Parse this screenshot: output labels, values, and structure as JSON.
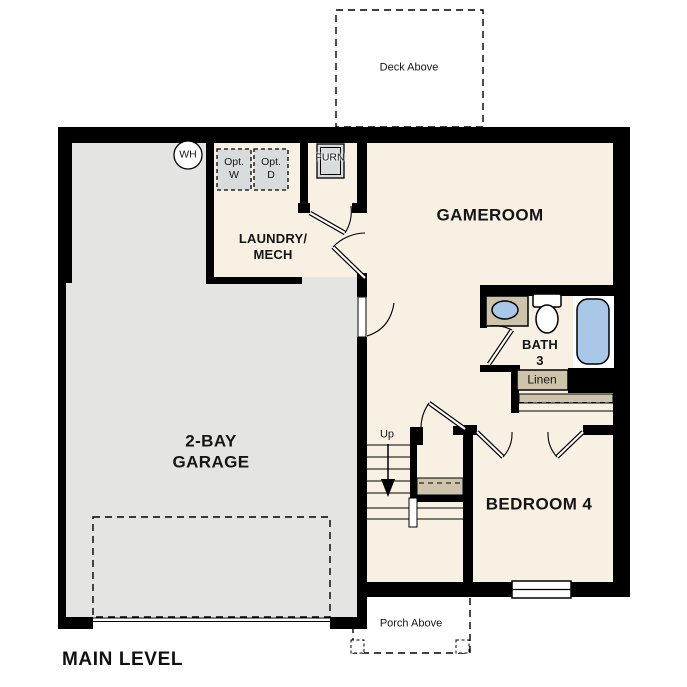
{
  "plan_title": {
    "label": "MAIN LEVEL"
  },
  "annotations": {
    "deck_above": "Deck Above",
    "porch_above": "Porch Above",
    "stairs_up": "Up"
  },
  "rooms": {
    "gameroom": "GAMEROOM",
    "laundry_mech": "LAUNDRY/\nMECH",
    "garage": "2-BAY\nGARAGE",
    "bath_3": "BATH\n3",
    "bedroom_4": "BEDROOM 4"
  },
  "closets": {
    "linen": "Linen"
  },
  "equipment": {
    "water_heater": "WH",
    "furnace": "FURN",
    "opt_washer": "Opt.\nW",
    "opt_dryer": "Opt.\nD"
  },
  "colors": {
    "wall": "#000000",
    "room_fill": "#f7f0e3",
    "garage_fill": "#e4e4e2",
    "fixture_tan": "#cec3ab",
    "fixture_blue": "#a9c7e6",
    "equipment_gray": "#d8dcdc"
  }
}
